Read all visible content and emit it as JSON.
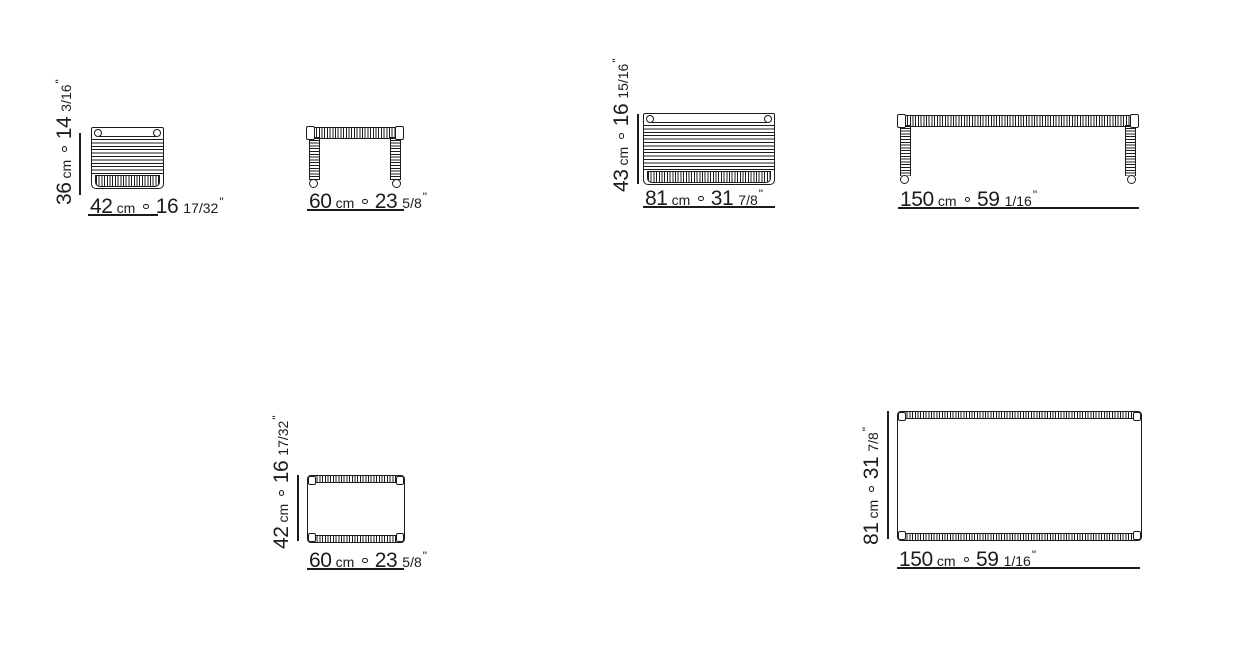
{
  "figure": {
    "background": "#ffffff",
    "line_color": "#1c1c1c",
    "separator": "ring"
  },
  "drawings": {
    "d1": {
      "width": {
        "cm": "42",
        "unit": "cm",
        "inches": "16",
        "fraction": "17/32",
        "prime": "\""
      },
      "height": {
        "cm": "36",
        "unit": "cm",
        "inches": "14",
        "fraction": "3/16",
        "prime": "\""
      }
    },
    "d2": {
      "width": {
        "cm": "60",
        "unit": "cm",
        "inches": "23",
        "fraction": "5/8",
        "prime": "\""
      }
    },
    "d3": {
      "width": {
        "cm": "81",
        "unit": "cm",
        "inches": "31",
        "fraction": "7/8",
        "prime": "\""
      },
      "height": {
        "cm": "43",
        "unit": "cm",
        "inches": "16",
        "fraction": "15/16",
        "prime": "\""
      }
    },
    "d4": {
      "width": {
        "cm": "150",
        "unit": "cm",
        "inches": "59",
        "fraction": "1/16",
        "prime": "\""
      }
    },
    "d5": {
      "width": {
        "cm": "60",
        "unit": "cm",
        "inches": "23",
        "fraction": "5/8",
        "prime": "\""
      },
      "depth": {
        "cm": "42",
        "unit": "cm",
        "inches": "16",
        "fraction": "17/32",
        "prime": "\""
      }
    },
    "d6": {
      "width": {
        "cm": "150",
        "unit": "cm",
        "inches": "59",
        "fraction": "1/16",
        "prime": "\""
      },
      "depth": {
        "cm": "81",
        "unit": "cm",
        "inches": "31",
        "fraction": "7/8",
        "prime": "\""
      }
    }
  }
}
